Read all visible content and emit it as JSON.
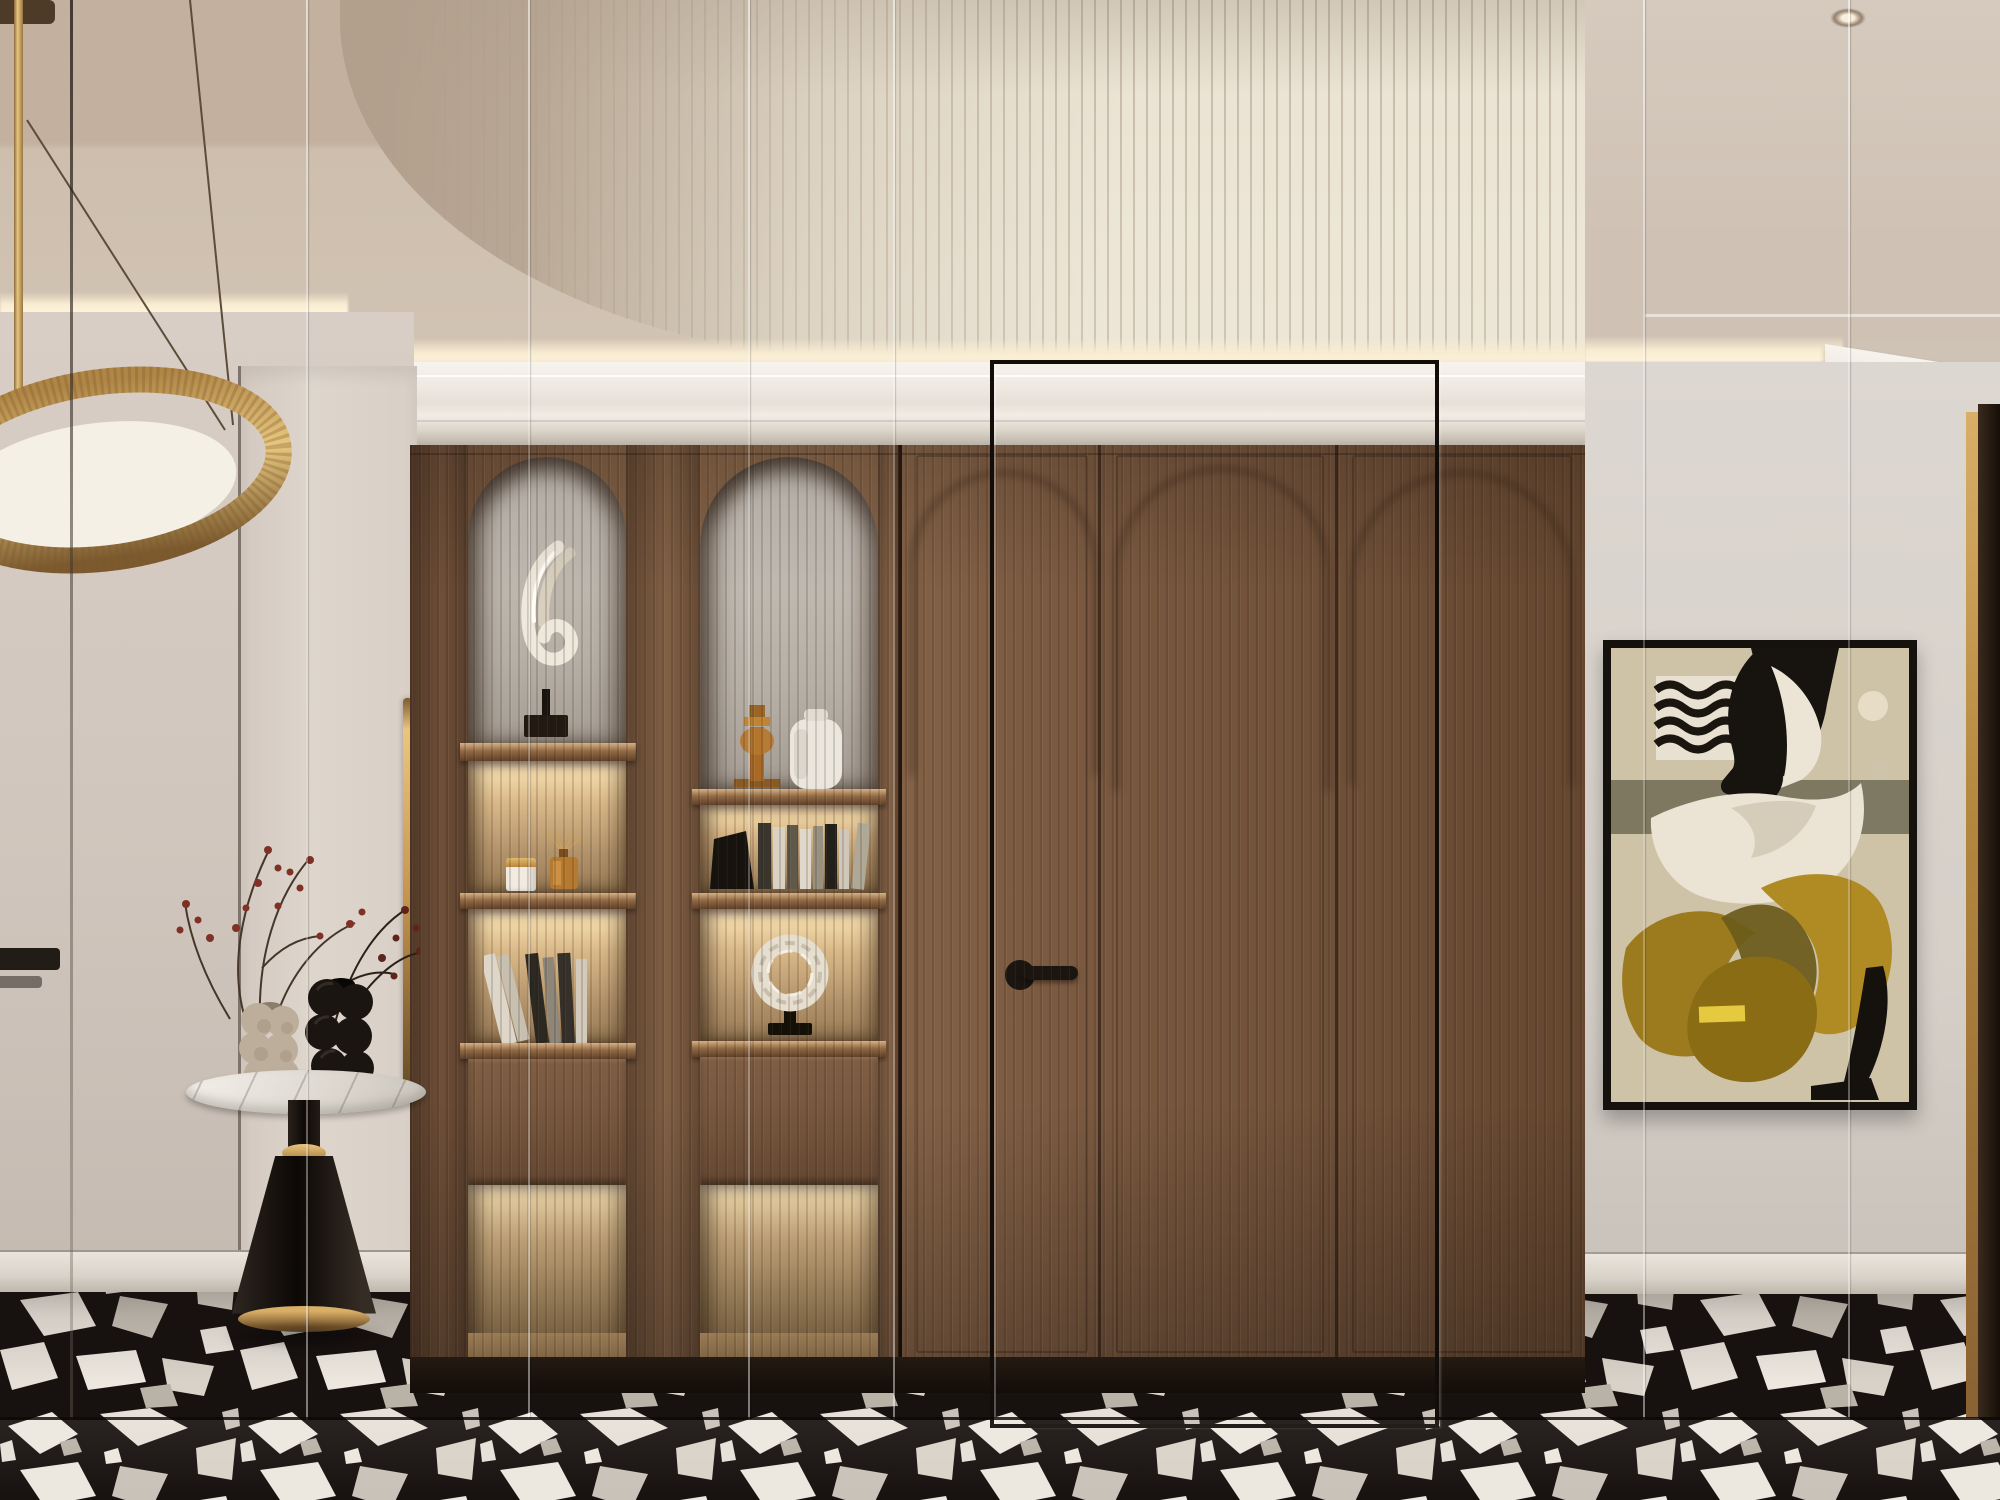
{
  "scene": {
    "description": "Luxury hallway interior render: fluted barrel-vault ceiling, walnut wardrobe wall with arched display niches and backlit shelves, abstract wall art, marble side table with bubble vases, black-and-white terrazzo floor, seen through seamed glass panels",
    "style": "modern-classic interior visualization"
  },
  "palette": {
    "vaultLit": "#ebe4d4",
    "vaultShadow": "#b09d8a",
    "ceilingBeige": "#c3b09e",
    "crownWhite": "#efeae3",
    "coveGlow": "#f8ecd2",
    "wallLeft": "#d5cbc3",
    "wallRight": "#d9d3cd",
    "wood": "#7c5b41",
    "woodDark": "#5e4330",
    "nicheGlow": "#f3d9a8",
    "plinth": "#1c140e",
    "floorBlack": "#171110",
    "floorShard": "#ece7df",
    "brass": "#c9995c",
    "brassHighlight": "#ecc57d",
    "marble": "#e9e6e1",
    "matteBlack": "#17120e",
    "artBackground": "#cec3a7",
    "artMustard": "#a9841f",
    "artOlive": "#6f6b52",
    "artCream": "#e8dfc9",
    "artYellow": "#e5c93e",
    "berryRed": "#7e3124"
  },
  "glass": {
    "seams": [
      {
        "x": 70,
        "tone": "dark"
      },
      {
        "x": 306,
        "tone": "light"
      },
      {
        "x": 528,
        "tone": "light"
      },
      {
        "x": 748,
        "tone": "light"
      },
      {
        "x": 893,
        "tone": "light"
      },
      {
        "x": 1643,
        "tone": "light"
      },
      {
        "x": 1848,
        "tone": "light"
      }
    ],
    "framed_panel": {
      "x": 990,
      "y": 360,
      "w": 441,
      "h": 1060
    },
    "bottom_edge_y": 1418
  },
  "wardrobe": {
    "sections": [
      {
        "name": "display-column-a",
        "arch_item": "white swirl sculpture on black base",
        "shelves": [
          "scented candle with gold lid + amber reed diffuser",
          "leaning books",
          "drawer front",
          "backlit open niche"
        ]
      },
      {
        "name": "display-column-b",
        "arch_item": "amber glass candleholder + white vase",
        "shelves": [
          "book row with black sculptural bookend",
          "white ring sculpture on black stand",
          "drawer front",
          "backlit open niche"
        ]
      },
      {
        "name": "door-panel-1",
        "detail": "recessed arch, black lever handle"
      },
      {
        "name": "door-panel-2",
        "detail": "recessed arch"
      },
      {
        "name": "door-panel-3",
        "detail": "recessed arch"
      }
    ]
  },
  "decor": {
    "pendant_lamp": "brass ring pendant with white diffuser disc",
    "side_table": "round marble top, black cone base with brass rings",
    "vases": [
      "beige bubble vase",
      "black bubble vase"
    ],
    "branches": "dried branches with dark red berries",
    "artwork": "abstract mid-century figure in black frame (beige, mustard, olive, black, wavy pattern block, cream circle)",
    "right_wall": "mirror panels reflecting ceiling spotlight and crown, brass-trimmed dark doorway"
  }
}
